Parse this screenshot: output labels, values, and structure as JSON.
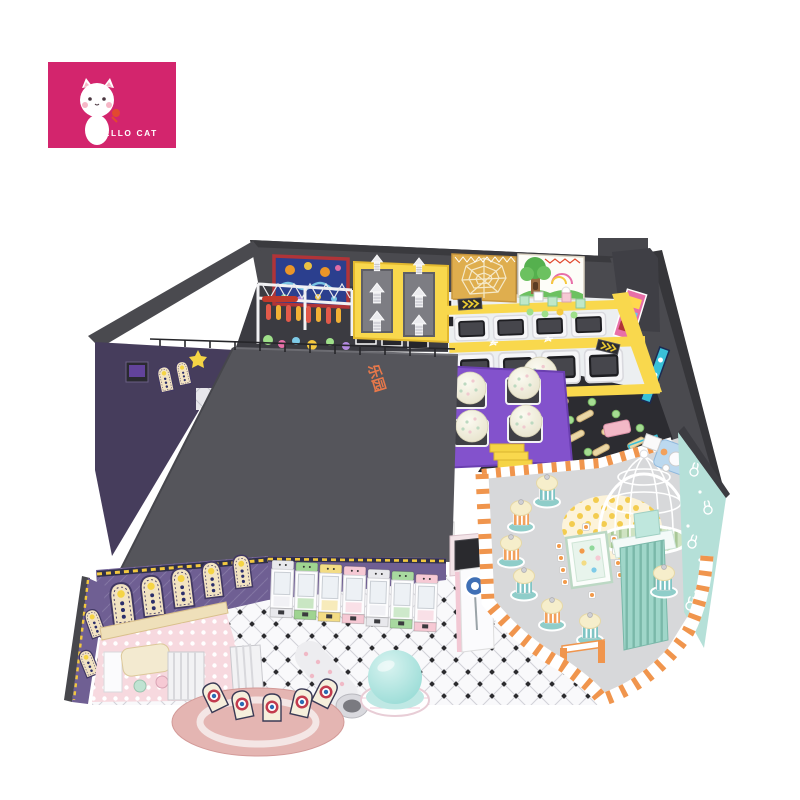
{
  "page": {
    "bg": "#ffffff"
  },
  "logo": {
    "brand_name": "HELLO CAT",
    "bg_color": "#d3256d",
    "mascot": "white-cat-mascot-holding-red-flower"
  },
  "scene": {
    "description": "isometric 3D render of an indoor kids playground floor plan",
    "roof_text": "乐园",
    "palette": {
      "magenta": "#d3256d",
      "wall": "#4a4a4f",
      "wall_dark": "#36363a",
      "roof": "#55555b",
      "floor_dark": "#2c2c31",
      "purple_wall": "#6f5f93",
      "purple_deck": "#8352cc",
      "yellow": "#f9d84d",
      "web_gold": "#dfae4e",
      "mural_blue": "#2b3f8e",
      "mural_frame": "#b03438",
      "forest_green": "#6cc160",
      "trampoline_white": "#eceff1",
      "party_floor": "#d7d8da",
      "orange": "#f0954d",
      "teal_wall": "#b5e0d8",
      "mint": "#9fd6c9",
      "dome_teal": "#8fd8d2",
      "pink_platform": "#e4b5b2",
      "polka_pink": "#f7d9df",
      "cream_arch": "#f2e3c2",
      "ball_cream": "#f0edda"
    },
    "zones": [
      "interactive-projection-wall",
      "punch-bag-truss",
      "climb-arrow-wall",
      "spider-web-wall",
      "forest-mural",
      "trampoline-park",
      "ball-trampoline-deck",
      "ninja-course",
      "storage-roof",
      "arch-wall",
      "claw-machine-row",
      "toddler-room",
      "target-shooting-platform",
      "spiral-slide",
      "inflatable-dome",
      "info-kiosk",
      "party-cafe",
      "birdcage-gazebo",
      "kids-corner",
      "checkered-floor",
      "rabbit-wall"
    ]
  }
}
